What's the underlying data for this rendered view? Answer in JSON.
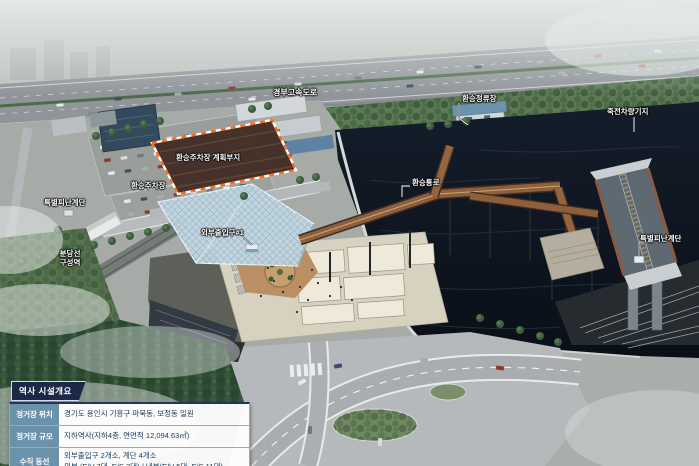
{
  "map_labels": {
    "expressway": "경부고속도로",
    "transfer_bus_stop": "환승정류장",
    "depot": "죽전차량기지",
    "parking_plan_site": "환승주차장 계획부지",
    "transfer_parking": "환승주차장",
    "evac_stair_left": "특별피난계단",
    "entrance_1": "외부출입구#1",
    "transfer_corridor": "환승통로",
    "evac_stair_right": "특별피난계단",
    "bundang_line": "분당선",
    "guseong_station": "구성역"
  },
  "info_panel": {
    "title": "역사 시설개요",
    "rows": [
      {
        "label": "정거장 위치",
        "value": "경기도 용인시 기흥구 마북동, 보정동 일원"
      },
      {
        "label": "정거장 규모",
        "value": "지하역사(지하4층, 연면적 12,094.63㎡)"
      },
      {
        "label": "수직 동선",
        "value": "외부출입구 2개소, 계단 4개소",
        "value_line2": "외부 (E/V 7대, E/S 3대) / 내부(E/V 5대, E/S 11대)"
      }
    ]
  },
  "colors": {
    "panel_title_bg": "#1b2947",
    "panel_label_bg": "#6b92ab",
    "panel_border": "#8ab0c4",
    "tape_orange": "#ff6a1a",
    "water": "#0d141f",
    "walkway_rust": "#8f5f3c"
  }
}
